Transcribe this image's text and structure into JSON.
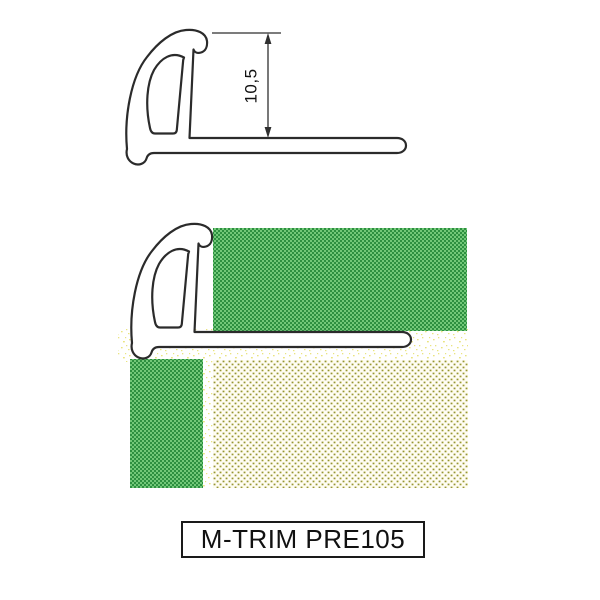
{
  "product_label": "M-TRIM PRE105",
  "cross_section_view": {
    "dimension_label": "10,5"
  },
  "colors": {
    "outline": "#2b2b2b",
    "dimension": "#2f2f2f",
    "text": "#111111",
    "tile_green_light": "#72c878",
    "tile_green_dark": "#2d9040",
    "mortar_bg": "#fffdf4",
    "mortar_dot": "#93933b",
    "mortar_halo": "#e6e28d",
    "speckle_bg": "#ffffff",
    "speckle_dot": "#eae47f",
    "label_border": "#1a1a1a"
  }
}
